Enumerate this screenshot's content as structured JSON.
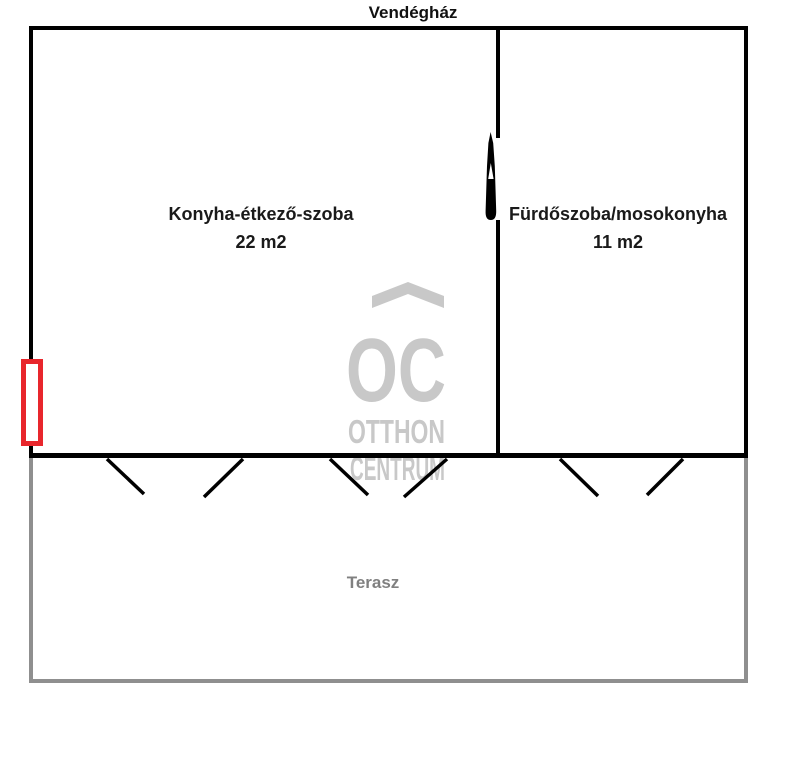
{
  "title": "Vendégház",
  "rooms": {
    "kitchen": {
      "name": "Konyha-étkező-szoba",
      "area": "22 m2"
    },
    "bathroom": {
      "name": "Fürdőszoba/mosokonyha",
      "area": "11 m2"
    }
  },
  "terrace": {
    "label": "Terasz"
  },
  "watermark": {
    "monogram": "OC",
    "line1": "OTTHON",
    "line2": "CENTRUM"
  },
  "colors": {
    "wall": "#000000",
    "terrace_border": "#8f8f8f",
    "terrace_label": "#808080",
    "window_marker": "#e8262c",
    "watermark": "#c8c8c8"
  }
}
